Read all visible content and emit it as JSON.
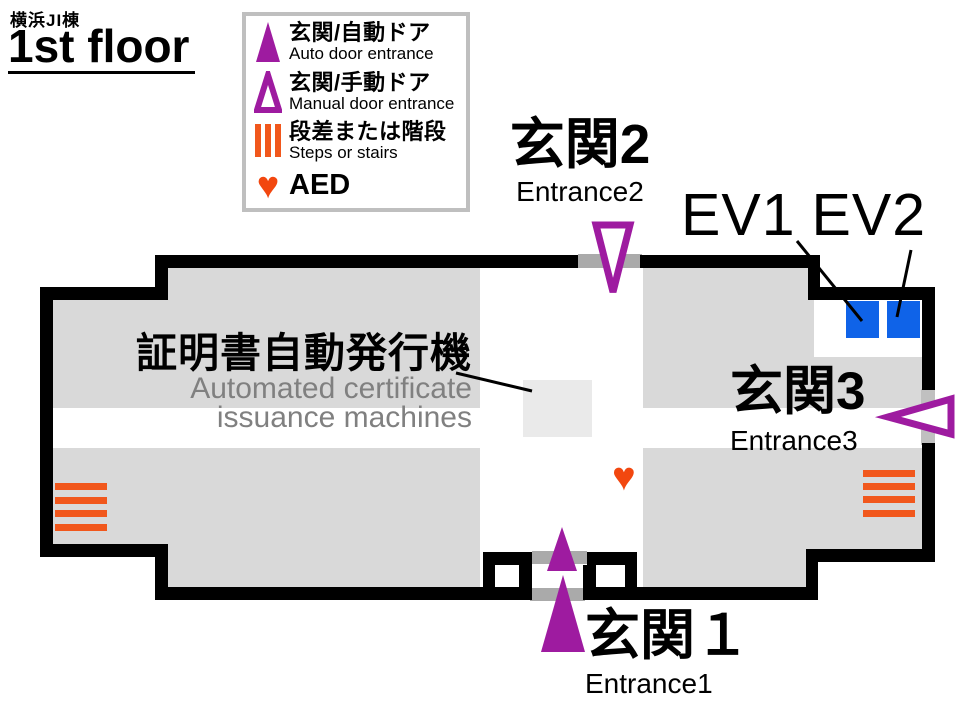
{
  "header": {
    "building": "横浜JI棟",
    "floor": "1st floor"
  },
  "legend": {
    "items": [
      {
        "jp": "玄関/自動ドア",
        "en": "Auto door entrance",
        "icon": "auto-door-triangle-filled"
      },
      {
        "jp": "玄関/手動ドア",
        "en": "Manual door entrance",
        "icon": "manual-door-triangle-outline"
      },
      {
        "jp": "段差または階段",
        "en": "Steps or stairs",
        "icon": "steps-bars"
      },
      {
        "jp": "AED",
        "en": "",
        "icon": "aed-heart"
      }
    ]
  },
  "labels": {
    "entrance1": {
      "jp": "玄関１",
      "en": "Entrance1"
    },
    "entrance2": {
      "jp": "玄関2",
      "en": "Entrance2"
    },
    "entrance3": {
      "jp": "玄関3",
      "en": "Entrance3"
    },
    "ev1": "EV1",
    "ev2": "EV2",
    "machine": {
      "jp": "証明書自動発行機",
      "en_line1": "Automated certificate",
      "en_line2": "issuance machines"
    }
  },
  "icons": {
    "heart_glyph": "♥"
  },
  "colors": {
    "wall": "#000000",
    "floor_gray": "#d9d9d9",
    "machine_fill": "#eaeaea",
    "threshold_gray": "#aaaaaa",
    "door_purple": "#9e1ba0",
    "elevator_blue": "#0f63e8",
    "steps_orange": "#f1571c",
    "aed_red": "#f2470f",
    "muted_text": "#808080",
    "legend_border": "#bfbfbf"
  }
}
